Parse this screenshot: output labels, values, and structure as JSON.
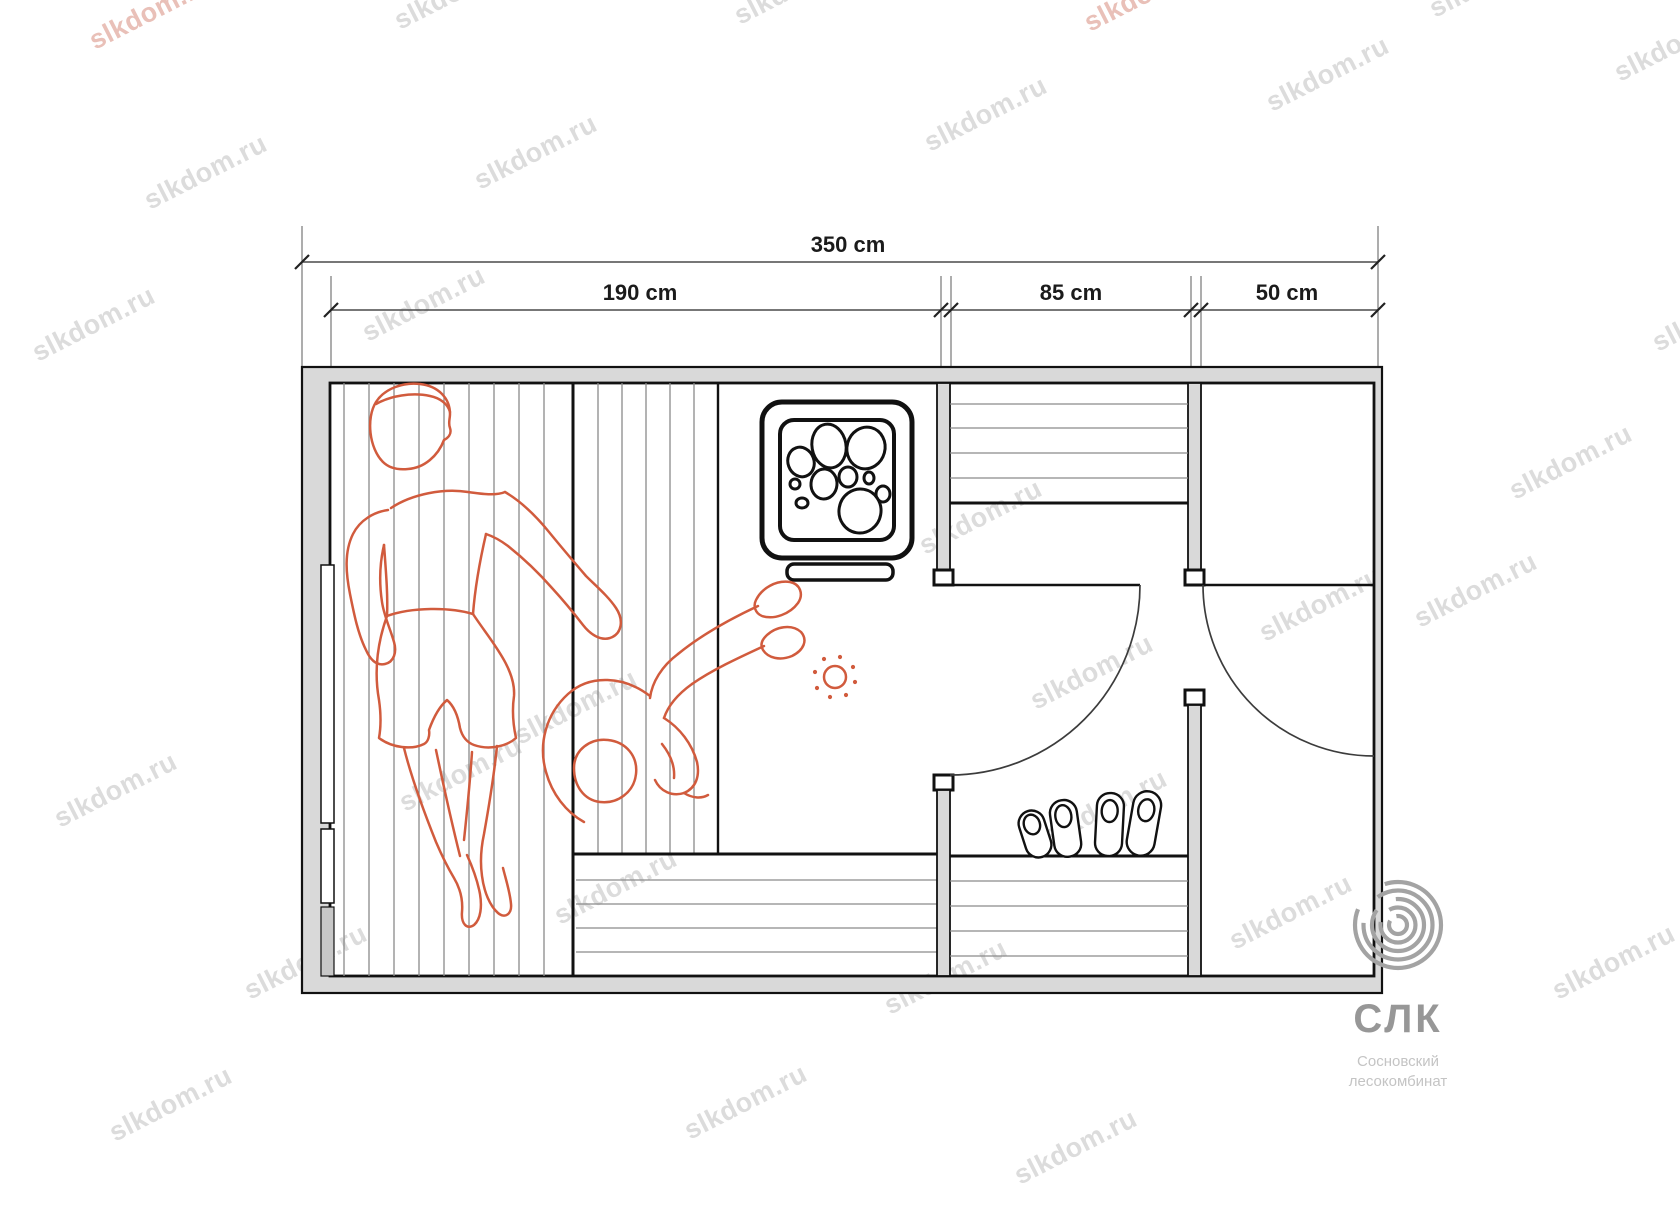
{
  "watermark": {
    "text": "slkdom.ru"
  },
  "dimensions": {
    "total": "350 cm",
    "sauna": "190 cm",
    "washroom": "85 cm",
    "entrance": "50 cm"
  },
  "logo": {
    "abbr": "СЛК",
    "subtitle_line1": "Сосновский",
    "subtitle_line2": "лесокомбинат"
  },
  "colors": {
    "figure_orange": "#d15b3d",
    "wall_gray": "#d9d9d9",
    "watermark_gray": "#dcdcdc",
    "watermark_pink": "#e9c0b8",
    "logo_gray": "#a3a3a3"
  }
}
